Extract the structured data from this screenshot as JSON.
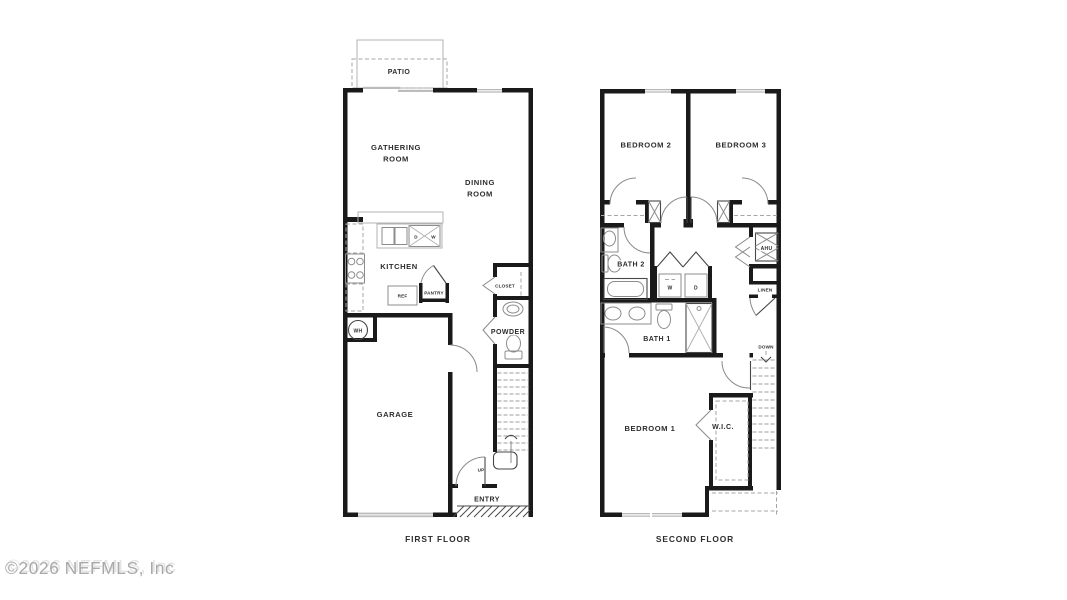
{
  "watermark": "©2026 NEFMLS, Inc",
  "first_floor": {
    "caption": "FIRST FLOOR",
    "patio": "PATIO",
    "gathering_1": "GATHERING",
    "gathering_2": "ROOM",
    "dining_1": "DINING",
    "dining_2": "ROOM",
    "kitchen": "KITCHEN",
    "dish_d": "D",
    "dish_w": "W",
    "ref": "REF",
    "pantry": "PANTRY",
    "wh": "WH",
    "closet": "CLOSET",
    "powder": "POWDER",
    "garage": "GARAGE",
    "up": "UP",
    "entry": "ENTRY"
  },
  "second_floor": {
    "caption": "SECOND FLOOR",
    "bedroom2": "BEDROOM 2",
    "bedroom3": "BEDROOM 3",
    "bath2": "BATH 2",
    "washer": "W",
    "dryer": "D",
    "ahu": "AHU",
    "linen": "LINEN",
    "bath1": "BATH 1",
    "down": "DOWN",
    "bedroom1": "BEDROOM 1",
    "wic": "W.I.C.",
    "colors": ""
  },
  "colors": {
    "wall": "#1a1a1a",
    "fixture": "#8c8c8c",
    "label": "#2d2d2d",
    "watermark": "#a9a9a9"
  }
}
